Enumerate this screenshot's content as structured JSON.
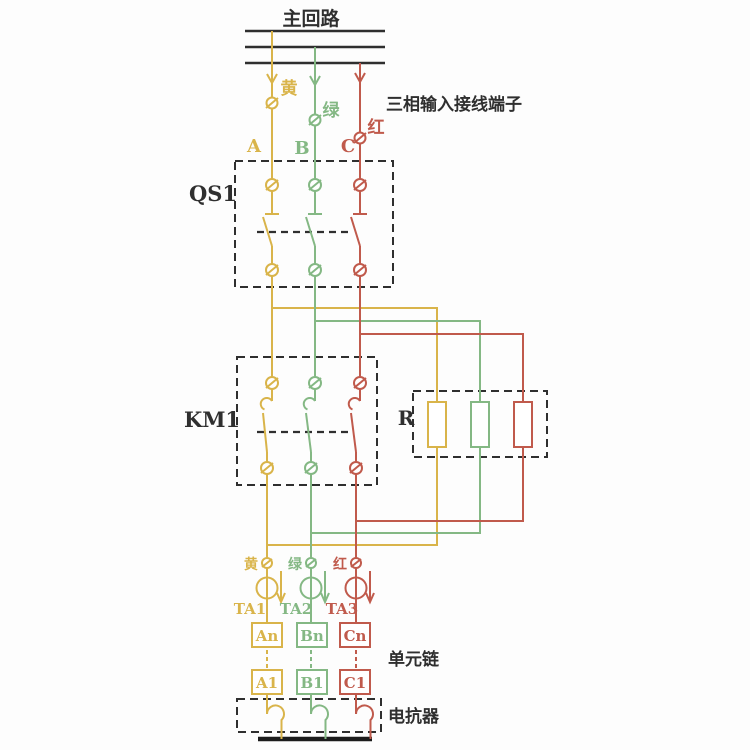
{
  "title": "主回路",
  "annotations": {
    "input_terminals": "三相输入接线端子",
    "unit_chain": "单元链",
    "reactor": "电抗器"
  },
  "components": {
    "disconnector_label": "QS1",
    "contactor_label": "KM1",
    "resistor_label": "R"
  },
  "phases": [
    {
      "id": "A",
      "wire_color_label": "黄",
      "phase_label": "A",
      "ct_label": "TA1",
      "cell_top": "An",
      "cell_bottom": "A1"
    },
    {
      "id": "B",
      "wire_color_label": "绿",
      "phase_label": "B",
      "ct_label": "TA2",
      "cell_top": "Bn",
      "cell_bottom": "B1"
    },
    {
      "id": "C",
      "wire_color_label": "红",
      "phase_label": "C",
      "ct_label": "TA3",
      "cell_top": "Cn",
      "cell_bottom": "C1"
    }
  ],
  "colors": {
    "phase_a": "#d9b44a",
    "phase_b": "#84b884",
    "phase_c": "#c05a4c",
    "line": "#2f2f2f",
    "bar": "#1c1c1c",
    "background": "#fdfdfd"
  }
}
